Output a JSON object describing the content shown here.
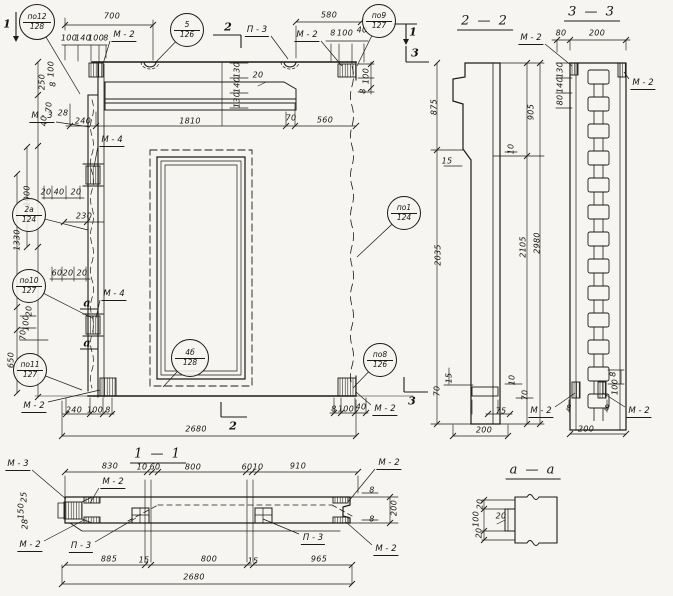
{
  "drawing": {
    "background": "#f6f5f1",
    "ink": "#1c1c16",
    "view_titles": [
      {
        "text": "1 — 1",
        "x": 158,
        "y": 455
      },
      {
        "text": "2 — 2",
        "x": 485,
        "y": 22
      },
      {
        "text": "3 — 3",
        "x": 592,
        "y": 13
      },
      {
        "text": "а — а",
        "x": 533,
        "y": 471
      }
    ],
    "callouts": [
      {
        "top": "по12",
        "bottom": "128",
        "x": 37,
        "y": 22,
        "r": 17,
        "lx": 80,
        "ly": 94
      },
      {
        "top": "5",
        "bottom": "126",
        "x": 187,
        "y": 30,
        "r": 16,
        "lx": 155,
        "ly": 63
      },
      {
        "top": "по9",
        "bottom": "127",
        "x": 379,
        "y": 21,
        "r": 16,
        "lx": 357,
        "ly": 66
      },
      {
        "top": "2а",
        "bottom": "124",
        "x": 29,
        "y": 215,
        "r": 16,
        "lx": 88,
        "ly": 230
      },
      {
        "top": "по10",
        "bottom": "127",
        "x": 29,
        "y": 286,
        "r": 16,
        "lx": 92,
        "ly": 318
      },
      {
        "top": "по11",
        "bottom": "127",
        "x": 30,
        "y": 370,
        "r": 16,
        "lx": 82,
        "ly": 390
      },
      {
        "top": "по1",
        "bottom": "124",
        "x": 404,
        "y": 213,
        "r": 16,
        "lx": 357,
        "ly": 257
      },
      {
        "top": "по8",
        "bottom": "126",
        "x": 380,
        "y": 360,
        "r": 16,
        "lx": 353,
        "ly": 388
      },
      {
        "top": "4б",
        "bottom": "128",
        "x": 190,
        "y": 358,
        "r": 18,
        "lx": 163,
        "ly": 387
      }
    ],
    "part_labels": [
      {
        "text": "М - 2",
        "x": 124,
        "y": 36,
        "lx": 103,
        "ly": 64
      },
      {
        "text": "М - 3",
        "x": 42,
        "y": 117,
        "lx": 90,
        "ly": 127
      },
      {
        "text": "М - 4",
        "x": 112,
        "y": 141,
        "lx": 94,
        "ly": 167
      },
      {
        "text": "М - 4",
        "x": 114,
        "y": 295,
        "lx": 96,
        "ly": 318
      },
      {
        "text": "М - 2",
        "x": 34,
        "y": 407,
        "lx": 100,
        "ly": 390
      },
      {
        "text": "М - 2",
        "x": 307,
        "y": 36,
        "lx": 342,
        "ly": 66
      },
      {
        "text": "М - 2",
        "x": 385,
        "y": 410,
        "lx": 356,
        "ly": 392
      },
      {
        "text": "П - 3",
        "x": 257,
        "y": 31,
        "lx": 288,
        "ly": 59
      },
      {
        "text": "М - 2",
        "x": 531,
        "y": 39,
        "lx": 572,
        "ly": 66
      },
      {
        "text": "М - 2",
        "x": 643,
        "y": 84,
        "lx": 624,
        "ly": 72
      },
      {
        "text": "М - 2",
        "x": 541,
        "y": 412,
        "lx": 575,
        "ly": 393
      },
      {
        "text": "М - 2",
        "x": 639,
        "y": 412,
        "lx": 603,
        "ly": 393
      },
      {
        "text": "М - 3",
        "x": 18,
        "y": 465,
        "lx": 66,
        "ly": 499
      },
      {
        "text": "М - 2",
        "x": 113,
        "y": 483,
        "lx": 90,
        "ly": 503
      },
      {
        "text": "М - 2",
        "x": 30,
        "y": 546,
        "lx": 84,
        "ly": 520
      },
      {
        "text": "П - 3",
        "x": 81,
        "y": 547,
        "lx": 136,
        "ly": 518
      },
      {
        "text": "П - 3",
        "x": 313,
        "y": 539,
        "lx": 263,
        "ly": 519
      },
      {
        "text": "М - 2",
        "x": 389,
        "y": 464,
        "lx": 348,
        "ly": 502
      },
      {
        "text": "М - 2",
        "x": 386,
        "y": 550,
        "lx": 346,
        "ly": 522
      }
    ],
    "dim_labels": [
      {
        "t": "700",
        "x": 112,
        "y": 16,
        "r": 0
      },
      {
        "t": "100",
        "x": 69,
        "y": 38,
        "r": 0
      },
      {
        "t": "140",
        "x": 83,
        "y": 38,
        "r": 0
      },
      {
        "t": "100",
        "x": 96,
        "y": 38,
        "r": 0
      },
      {
        "t": "8",
        "x": 106,
        "y": 38,
        "r": 0
      },
      {
        "t": "580",
        "x": 329,
        "y": 15,
        "r": 0
      },
      {
        "t": "8",
        "x": 333,
        "y": 33,
        "r": 0
      },
      {
        "t": "100",
        "x": 345,
        "y": 33,
        "r": 0
      },
      {
        "t": "40",
        "x": 362,
        "y": 30,
        "r": 0
      },
      {
        "t": "250",
        "x": 42,
        "y": 82,
        "r": 1
      },
      {
        "t": "100",
        "x": 51,
        "y": 69,
        "r": 1
      },
      {
        "t": "8",
        "x": 53,
        "y": 84,
        "r": 1
      },
      {
        "t": "70",
        "x": 49,
        "y": 107,
        "r": 1
      },
      {
        "t": "40",
        "x": 44,
        "y": 121,
        "r": 1
      },
      {
        "t": "1000",
        "x": 27,
        "y": 196,
        "r": 1
      },
      {
        "t": "28",
        "x": 63,
        "y": 113,
        "r": 0
      },
      {
        "t": "130",
        "x": 237,
        "y": 70,
        "r": 1
      },
      {
        "t": "140",
        "x": 237,
        "y": 85,
        "r": 1
      },
      {
        "t": "130",
        "x": 237,
        "y": 100,
        "r": 1
      },
      {
        "t": "20",
        "x": 258,
        "y": 75,
        "r": 0
      },
      {
        "t": "240",
        "x": 83,
        "y": 121,
        "r": 0
      },
      {
        "t": "1810",
        "x": 190,
        "y": 121,
        "r": 0
      },
      {
        "t": "70",
        "x": 291,
        "y": 118,
        "r": 0
      },
      {
        "t": "560",
        "x": 325,
        "y": 120,
        "r": 0
      },
      {
        "t": "100",
        "x": 366,
        "y": 76,
        "r": 1
      },
      {
        "t": "8",
        "x": 363,
        "y": 91,
        "r": 1
      },
      {
        "t": "20",
        "x": 46,
        "y": 192,
        "r": 0
      },
      {
        "t": "40",
        "x": 59,
        "y": 192,
        "r": 0
      },
      {
        "t": "20",
        "x": 76,
        "y": 192,
        "r": 0
      },
      {
        "t": "230",
        "x": 84,
        "y": 216,
        "r": 0
      },
      {
        "t": "1330",
        "x": 17,
        "y": 240,
        "r": 1
      },
      {
        "t": "20",
        "x": 29,
        "y": 311,
        "r": 1
      },
      {
        "t": "100",
        "x": 26,
        "y": 323,
        "r": 1
      },
      {
        "t": "70",
        "x": 23,
        "y": 335,
        "r": 1
      },
      {
        "t": "60",
        "x": 57,
        "y": 273,
        "r": 0
      },
      {
        "t": "20",
        "x": 68,
        "y": 273,
        "r": 0
      },
      {
        "t": "20",
        "x": 82,
        "y": 273,
        "r": 0
      },
      {
        "t": "650",
        "x": 11,
        "y": 360,
        "r": 1
      },
      {
        "t": "240",
        "x": 74,
        "y": 410,
        "r": 0
      },
      {
        "t": "100",
        "x": 95,
        "y": 410,
        "r": 0
      },
      {
        "t": "8",
        "x": 108,
        "y": 410,
        "r": 0
      },
      {
        "t": "2680",
        "x": 196,
        "y": 429,
        "r": 0
      },
      {
        "t": "8",
        "x": 334,
        "y": 409,
        "r": 0
      },
      {
        "t": "100",
        "x": 346,
        "y": 409,
        "r": 0
      },
      {
        "t": "40",
        "x": 361,
        "y": 407,
        "r": 0
      },
      {
        "t": "875",
        "x": 434,
        "y": 107,
        "r": 1
      },
      {
        "t": "2035",
        "x": 438,
        "y": 255,
        "r": 1
      },
      {
        "t": "905",
        "x": 531,
        "y": 112,
        "r": 1
      },
      {
        "t": "2105",
        "x": 523,
        "y": 247,
        "r": 1
      },
      {
        "t": "2980",
        "x": 537,
        "y": 243,
        "r": 1
      },
      {
        "t": "15",
        "x": 447,
        "y": 161,
        "r": 0
      },
      {
        "t": "10",
        "x": 511,
        "y": 149,
        "r": 1
      },
      {
        "t": "15",
        "x": 449,
        "y": 378,
        "r": 1
      },
      {
        "t": "70",
        "x": 437,
        "y": 391,
        "r": 1
      },
      {
        "t": "10",
        "x": 512,
        "y": 380,
        "r": 1
      },
      {
        "t": "70",
        "x": 525,
        "y": 395,
        "r": 1
      },
      {
        "t": "75",
        "x": 501,
        "y": 411,
        "r": 0
      },
      {
        "t": "200",
        "x": 484,
        "y": 430,
        "r": 0
      },
      {
        "t": "80",
        "x": 561,
        "y": 33,
        "r": 0
      },
      {
        "t": "200",
        "x": 597,
        "y": 33,
        "r": 0
      },
      {
        "t": "130",
        "x": 560,
        "y": 70,
        "r": 1
      },
      {
        "t": "140",
        "x": 560,
        "y": 85,
        "r": 1
      },
      {
        "t": "80",
        "x": 560,
        "y": 100,
        "r": 1
      },
      {
        "t": "8",
        "x": 613,
        "y": 374,
        "r": 1
      },
      {
        "t": "100",
        "x": 615,
        "y": 387,
        "r": 1
      },
      {
        "t": "8",
        "x": 569,
        "y": 408,
        "r": 0
      },
      {
        "t": "8",
        "x": 607,
        "y": 408,
        "r": 0
      },
      {
        "t": "200",
        "x": 586,
        "y": 429,
        "r": 0
      },
      {
        "t": "830",
        "x": 110,
        "y": 466,
        "r": 0
      },
      {
        "t": "10",
        "x": 142,
        "y": 467,
        "r": 0
      },
      {
        "t": "60",
        "x": 155,
        "y": 467,
        "r": 0
      },
      {
        "t": "800",
        "x": 193,
        "y": 467,
        "r": 0
      },
      {
        "t": "60",
        "x": 247,
        "y": 467,
        "r": 0
      },
      {
        "t": "10",
        "x": 258,
        "y": 467,
        "r": 0
      },
      {
        "t": "910",
        "x": 298,
        "y": 466,
        "r": 0
      },
      {
        "t": "25",
        "x": 24,
        "y": 497,
        "r": 1
      },
      {
        "t": "150",
        "x": 21,
        "y": 511,
        "r": 1
      },
      {
        "t": "28",
        "x": 25,
        "y": 524,
        "r": 1
      },
      {
        "t": "8",
        "x": 372,
        "y": 490,
        "r": 0
      },
      {
        "t": "8",
        "x": 372,
        "y": 519,
        "r": 0
      },
      {
        "t": "200",
        "x": 394,
        "y": 508,
        "r": 1
      },
      {
        "t": "885",
        "x": 109,
        "y": 559,
        "r": 0
      },
      {
        "t": "15",
        "x": 144,
        "y": 560,
        "r": 0
      },
      {
        "t": "800",
        "x": 209,
        "y": 559,
        "r": 0
      },
      {
        "t": "15",
        "x": 253,
        "y": 561,
        "r": 0
      },
      {
        "t": "965",
        "x": 319,
        "y": 559,
        "r": 0
      },
      {
        "t": "2680",
        "x": 194,
        "y": 577,
        "r": 0
      },
      {
        "t": "20",
        "x": 480,
        "y": 504,
        "r": 1
      },
      {
        "t": "100",
        "x": 476,
        "y": 519,
        "r": 1
      },
      {
        "t": "20",
        "x": 479,
        "y": 533,
        "r": 1
      },
      {
        "t": "20",
        "x": 501,
        "y": 516,
        "r": 0
      }
    ],
    "section_marks": [
      {
        "t": "1",
        "x": 7,
        "y": 24,
        "lines": [
          [
            16,
            12,
            16,
            38
          ]
        ],
        "arrow": [
          16,
          42
        ]
      },
      {
        "t": "1",
        "x": 413,
        "y": 32,
        "lines": [
          [
            393,
            24,
            417,
            24
          ],
          [
            406,
            24,
            406,
            41
          ]
        ],
        "arrow": [
          406,
          45
        ]
      },
      {
        "t": "2",
        "x": 228,
        "y": 27,
        "lines": [
          [
            213,
            35,
            241,
            35
          ],
          [
            241,
            35,
            241,
            48
          ]
        ]
      },
      {
        "t": "2",
        "x": 233,
        "y": 426,
        "lines": [
          [
            221,
            402,
            221,
            417
          ],
          [
            221,
            417,
            247,
            417
          ]
        ]
      },
      {
        "t": "3",
        "x": 415,
        "y": 53,
        "lines": [
          [
            406,
            46,
            406,
            62
          ],
          [
            406,
            62,
            429,
            62
          ]
        ]
      },
      {
        "t": "3",
        "x": 412,
        "y": 401,
        "lines": [
          [
            404,
            377,
            404,
            392
          ],
          [
            404,
            392,
            428,
            392
          ]
        ]
      },
      {
        "t": "а",
        "x": 87,
        "y": 303,
        "lines": [
          [
            80,
            309,
            98,
            309
          ]
        ]
      },
      {
        "t": "а",
        "x": 87,
        "y": 343,
        "lines": [
          [
            80,
            349,
            98,
            349
          ]
        ]
      }
    ]
  }
}
